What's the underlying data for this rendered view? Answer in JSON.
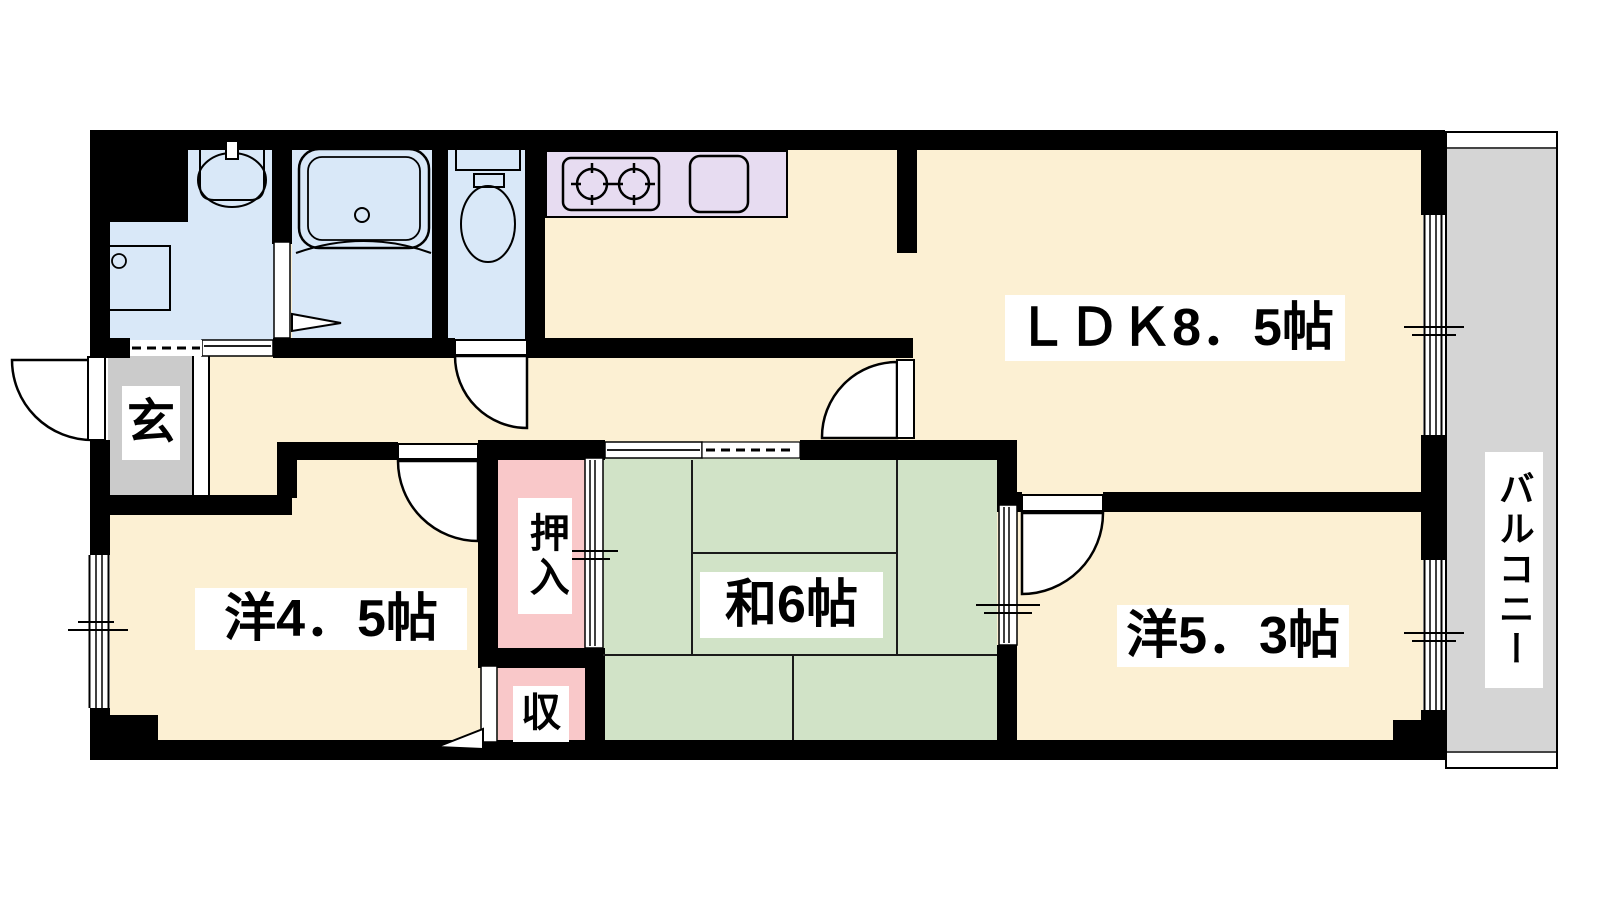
{
  "rooms": {
    "ldk": "ＬＤＫ8．5帖",
    "western_4_5": "洋4．5帖",
    "japanese_6": "和6帖",
    "western_5_3": "洋5．3帖",
    "entrance": "玄",
    "closet_oshiire": "押入",
    "closet_storage": "収",
    "balcony": "バルコニー"
  },
  "colors": {
    "room_floor": "#FCF0D3",
    "wet_area": "#D9E8F8",
    "kitchen_counter": "#E7DCF1",
    "tatami": "#D1E3C7",
    "closet": "#F9C8C9",
    "entrance_floor": "#CBCBCB",
    "balcony_floor": "#D5D5D5",
    "wall": "#000000",
    "label_bg": "#FFFFFF"
  }
}
